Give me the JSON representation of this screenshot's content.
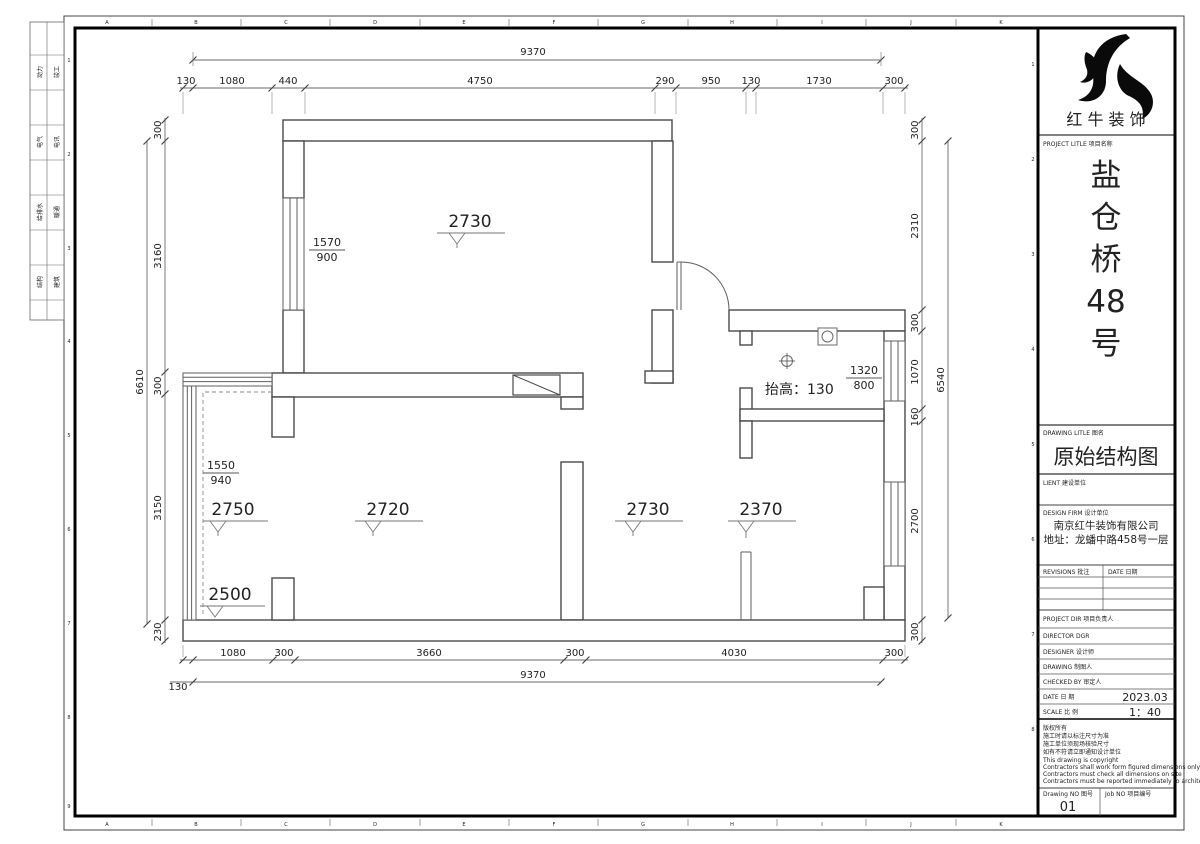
{
  "sheet": {
    "ruler_letters": [
      "A",
      "B",
      "C",
      "D",
      "E",
      "F",
      "G",
      "H",
      "I",
      "J",
      "K"
    ],
    "ruler_numbers": [
      "1",
      "2",
      "3",
      "4",
      "5",
      "6",
      "7",
      "8",
      "9"
    ],
    "discipline_strip": [
      {
        "a": "动力",
        "b": "竣工"
      },
      {
        "a": "电气",
        "b": "电讯"
      },
      {
        "a": "给排水",
        "b": "暖通"
      },
      {
        "a": "结构",
        "b": "建筑"
      }
    ]
  },
  "plan": {
    "dims": {
      "top_total": "9370",
      "top": [
        "130",
        "1080",
        "440",
        "4750",
        "290",
        "950",
        "130",
        "1730",
        "300"
      ],
      "left": [
        "300",
        "3160",
        "300",
        "3150",
        "230"
      ],
      "left_total": "6610",
      "right": [
        "300",
        "2310",
        "300",
        "1070",
        "160",
        "2700",
        "300"
      ],
      "right_total": "6540",
      "bottom": [
        "1080",
        "300",
        "3660",
        "300",
        "4030",
        "300"
      ],
      "bottom_offset": "130",
      "bottom_total": "9370"
    },
    "levels": {
      "room_top": "2730",
      "left_mid": "2750",
      "left_low": "2500",
      "living": "2720",
      "hall": "2730",
      "right_room": "2370"
    },
    "windows": {
      "w1": {
        "num": "1570",
        "den": "900"
      },
      "w2": {
        "num": "1550",
        "den": "940"
      },
      "w3": {
        "num": "1320",
        "den": "800"
      }
    },
    "notes": {
      "raise": "抬高：130"
    }
  },
  "titleblock": {
    "brand": "红 牛 装 饰",
    "project_label": "PROJECT LITLE  项目名称",
    "project_name_chars": [
      "盐",
      "仓",
      "桥",
      "48",
      "号"
    ],
    "drawing_label": "DRAWING LITLE  图名",
    "drawing_title": "原始结构图",
    "client_label": "LIENT  建设单位",
    "design_firm_label": "DESIGN FIRM  设计单位",
    "firm_name": "南京红牛装饰有限公司",
    "firm_address": "地址：龙蟠中路458号一层",
    "revisions_label": "REVISIONS  批注",
    "date_label": "DATE  日期",
    "project_dir_label": "PROJECT DIR  项目负责人",
    "director_label": "DIRECTOR DGR",
    "designer_label": "DESIGNER    设计师",
    "drawing_by_label": "DRAWING    制图人",
    "checked_by_label": "CHECKED BY   审定人",
    "date_row_label": "DATE      日  期",
    "date_value": "2023.03",
    "scale_row_label": "SCALE     比  例",
    "scale_value": "1：40",
    "notes": [
      "版权所有",
      "施工时请以标注尺寸为准",
      "施工单位须现场核验尺寸",
      "如有不符请立即通知设计单位",
      "This drawing is copyright",
      "Contractors shall work form figured dimensions only",
      "Contractors must check all dimensions on site",
      "Contractors must be reported immediately to architects"
    ],
    "drawing_no_label": "Drawing NO  图号",
    "drawing_no": "01",
    "job_no_label": "Job NO  项目编号"
  }
}
